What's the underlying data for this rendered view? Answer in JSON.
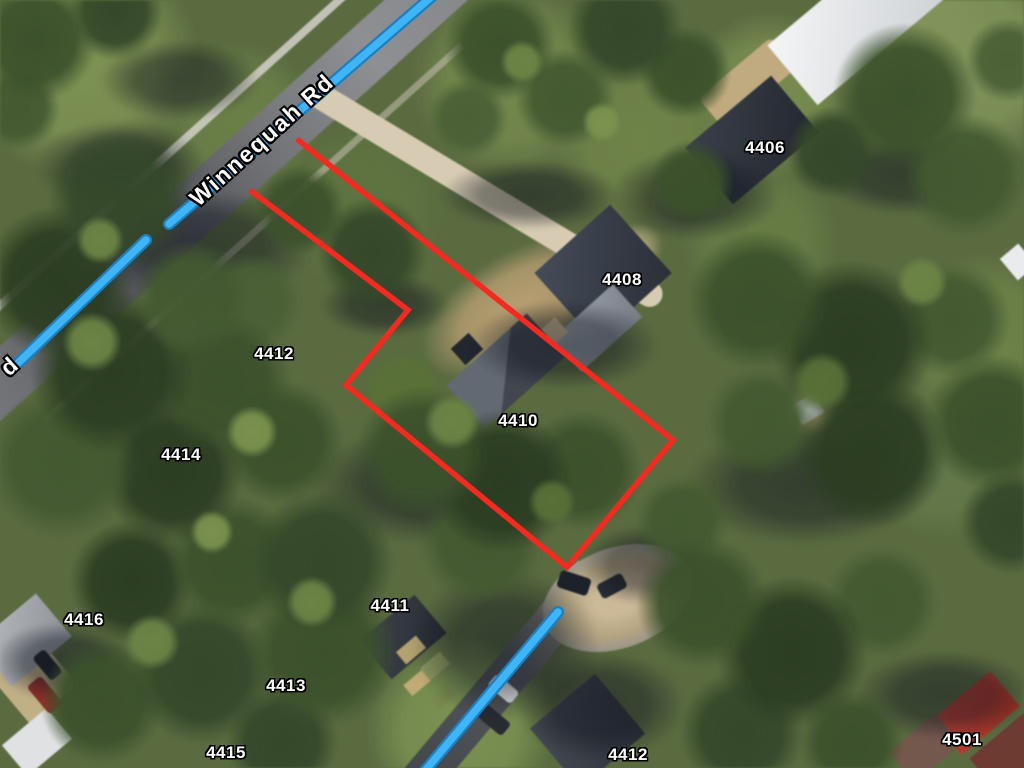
{
  "map": {
    "road_labels": [
      {
        "text": "Winnequah Rd"
      },
      {
        "text": "d"
      }
    ],
    "address_labels": [
      {
        "text": "4406"
      },
      {
        "text": "4408"
      },
      {
        "text": "4412"
      },
      {
        "text": "4410"
      },
      {
        "text": "4414"
      },
      {
        "text": "4416"
      },
      {
        "text": "4411"
      },
      {
        "text": "4413"
      },
      {
        "text": "4415"
      },
      {
        "text": "4412"
      },
      {
        "text": "4501"
      }
    ],
    "overlays": {
      "parcel_outline": {
        "color": "#f5291f",
        "stroke_width": 5.5,
        "points": "250,190 408,310 346,385 567,567 673,440 297,139"
      },
      "route_lines": {
        "inner_color": "#3fb4f6",
        "outer_color": "#1b7fc0",
        "inner_width": 7.5,
        "outer_width": 12,
        "segments": [
          {
            "points": "437,-8 169,224"
          },
          {
            "points": "146,240 14,367"
          },
          {
            "points": "558,612 424,772"
          }
        ]
      }
    }
  }
}
